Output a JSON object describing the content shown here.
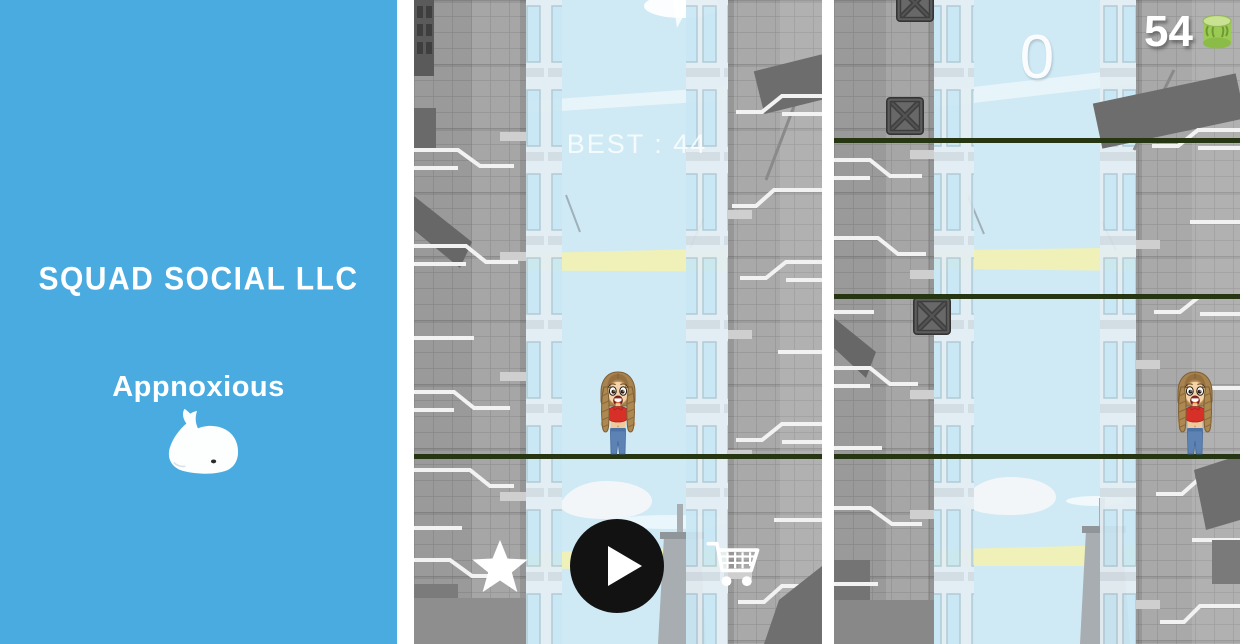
{
  "branding": {
    "company": "SQUAD SOCIAL LLC",
    "studio": "Appnoxious",
    "logo_icon": "whale-icon",
    "background_color": "#49ABE0"
  },
  "menu_screen": {
    "best_score_label": "BEST : 44",
    "buttons": {
      "rate_icon": "star-icon",
      "play_icon": "play-icon",
      "shop_icon": "cart-icon"
    }
  },
  "gameplay_screen": {
    "score": "0",
    "coin_count": "54",
    "coin_icon": "coin-stack-icon"
  },
  "colors": {
    "brand_blue": "#49ABE0",
    "sky_blue": "#CFEAF5",
    "sunbeam_yellow": "#EFF1B8",
    "wire_green": "#263612",
    "crate_gray": "#5C5C5C",
    "play_button_black": "#121212",
    "text_white": "#FFFFFF"
  }
}
